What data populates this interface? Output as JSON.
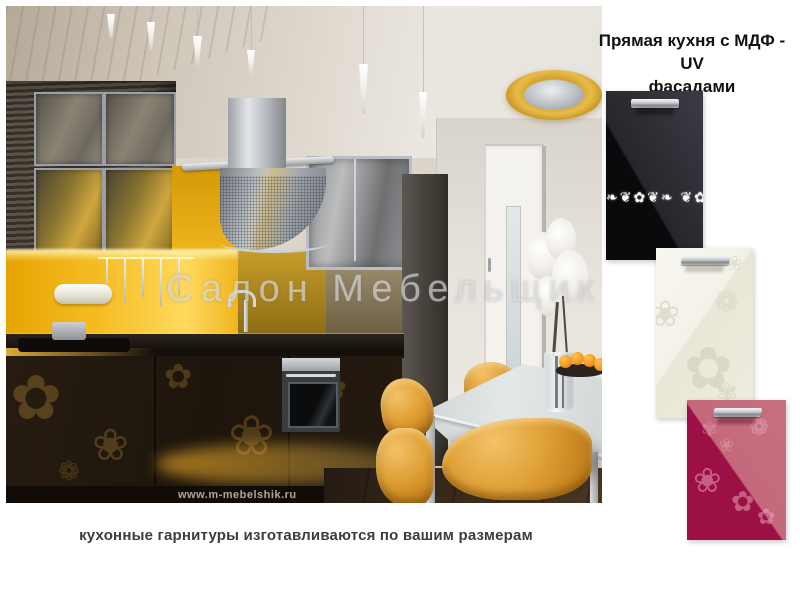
{
  "header": {
    "title_line1": "Прямая кухня с МДФ - UV",
    "title_line2": "фасадами"
  },
  "photo": {
    "watermark": "Салон Мебельщик",
    "website": "www.m-mebelshik.ru",
    "scene": "straight kitchen with dark striped cabinets, gold backsplash, steel hood, white dining table, amber chairs"
  },
  "samples": [
    {
      "id": "black-gloss-ornament",
      "base_color": "#0a0a0c",
      "highlight_color": "#3c3c45",
      "ornament_color": "#ffffff"
    },
    {
      "id": "cream-floral",
      "base_color": "#f2f0e7",
      "pattern_color": "#dcd8c6"
    },
    {
      "id": "magenta-floral",
      "base_color": "#9c1045",
      "highlight_color": "#c4697c",
      "pattern_color": "#e29cb0"
    }
  ],
  "glyphs": {
    "scroll": "❧❦✿❦❧ ❦✿❦ ❧❦✿❦❧",
    "flower_a": "✿",
    "flower_b": "❀",
    "flower_c": "❁",
    "flower_d": "✾"
  },
  "footer": {
    "caption": "кухонные гарнитуры изготавливаются по вашим размерам"
  }
}
